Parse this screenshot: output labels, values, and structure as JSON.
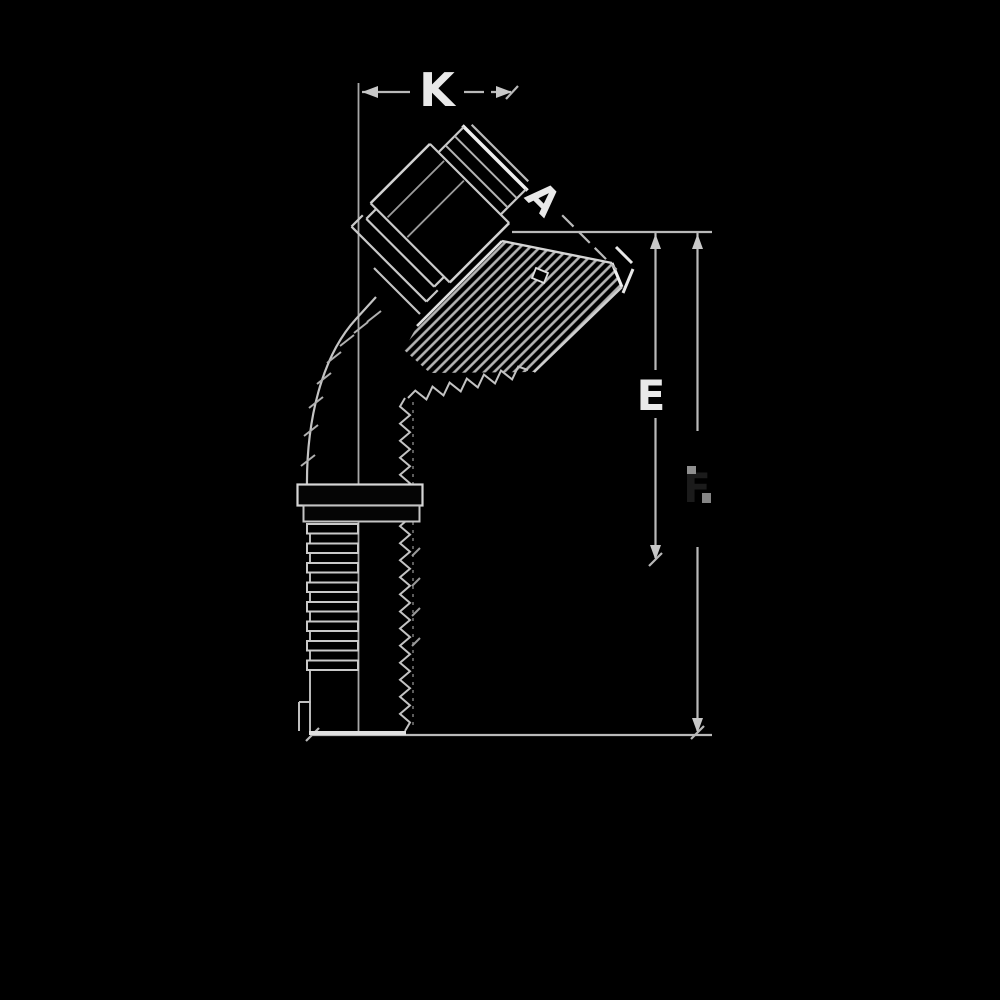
{
  "diagram": {
    "type": "technical-drawing",
    "subject": "45-degree elbow hydraulic hose fitting, side elevation",
    "background_color": "#000000",
    "line_color": "#c8c8c8",
    "labels": {
      "k": "K",
      "a": "A",
      "e": "E",
      "f": "F"
    },
    "dimension_positions": {
      "k": "top horizontal",
      "a": "diagonal 45-degree along port face",
      "e": "inner right vertical",
      "f": "outer right vertical (label barely visible)"
    }
  }
}
